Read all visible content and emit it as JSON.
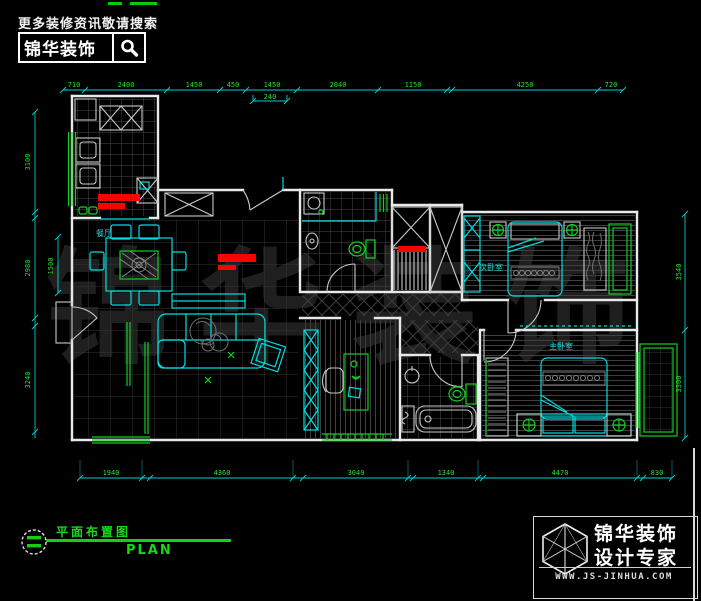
{
  "header": {
    "hint": "更多装修资讯敬请搜索",
    "brand": "锦华装饰"
  },
  "watermark": "锦华装饰",
  "plan": {
    "rooms": {
      "dining": "餐厅",
      "bed2": "次卧室",
      "master": "主卧室"
    },
    "dims": {
      "top": [
        "710",
        "2400",
        "1450",
        "450",
        "1450",
        "2040",
        "1150",
        "4250",
        "720"
      ],
      "top_sub": "240",
      "bottom": [
        "1940",
        "4360",
        "3040",
        "1340",
        "4470",
        "830"
      ],
      "left": [
        "3100",
        "2980",
        "3240"
      ],
      "left_inner": "1500",
      "right": [
        "3540",
        "3300"
      ]
    }
  },
  "titleblock": {
    "title": "平面布置图",
    "subtitle": "PLAN"
  },
  "footer": {
    "brand_line1": "锦华装饰",
    "brand_line2": "设计专家",
    "url": "WWW.JS-JINHUA.COM"
  },
  "colors": {
    "wall": "#e9e9e9",
    "accent_cyan": "#00dede",
    "accent_green": "#11cf22",
    "highlight_red": "#f50400"
  }
}
